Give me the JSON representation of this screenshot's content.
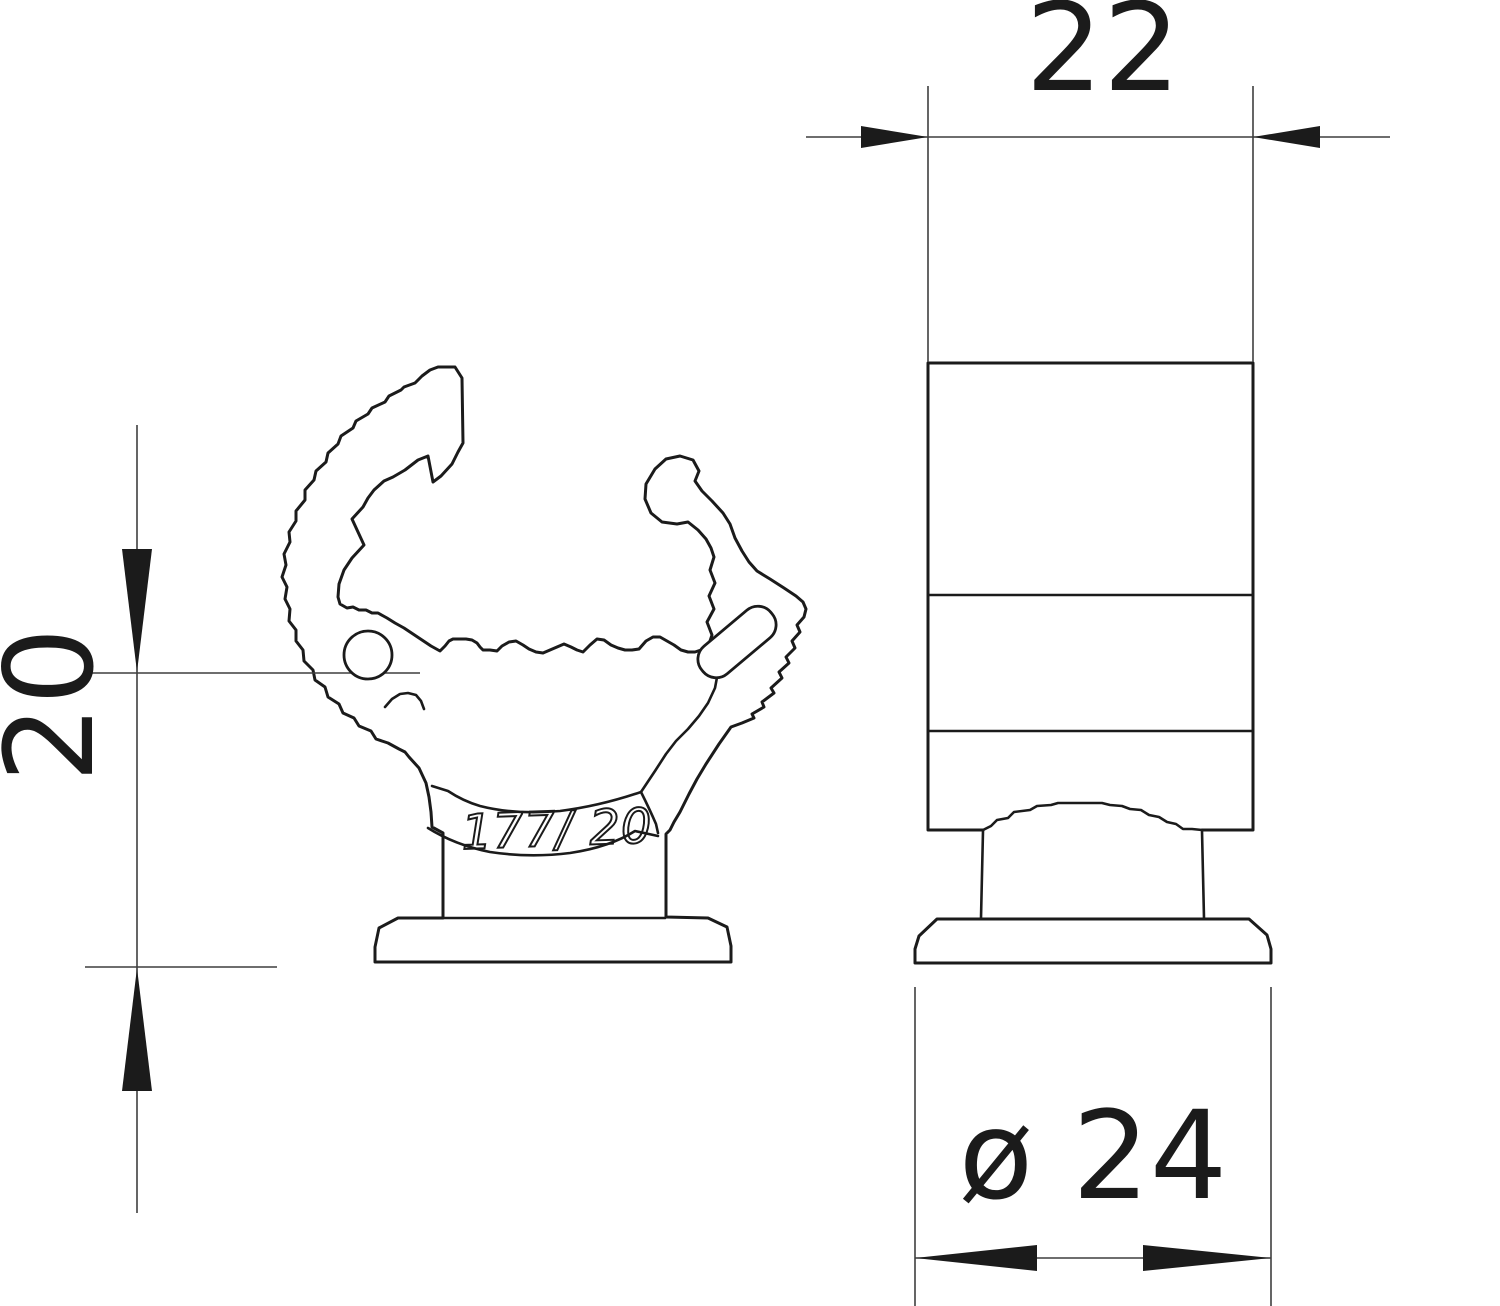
{
  "drawing": {
    "type": "technical-dimension-drawing",
    "views": {
      "side_view": "pipe clamp profile with snap hooks, mounting neck and base flange",
      "front_view": "clamp front elevation with neck and base flange"
    }
  },
  "dimensions": {
    "width": {
      "label": "22"
    },
    "height": {
      "label": "20"
    },
    "diameter": {
      "label": "ø 24"
    }
  },
  "part_marking": {
    "text": "177/ 20"
  },
  "colors": {
    "ink": "#1b1b1b",
    "thin_line": "#3f3f3f",
    "background": "#ffffff"
  }
}
